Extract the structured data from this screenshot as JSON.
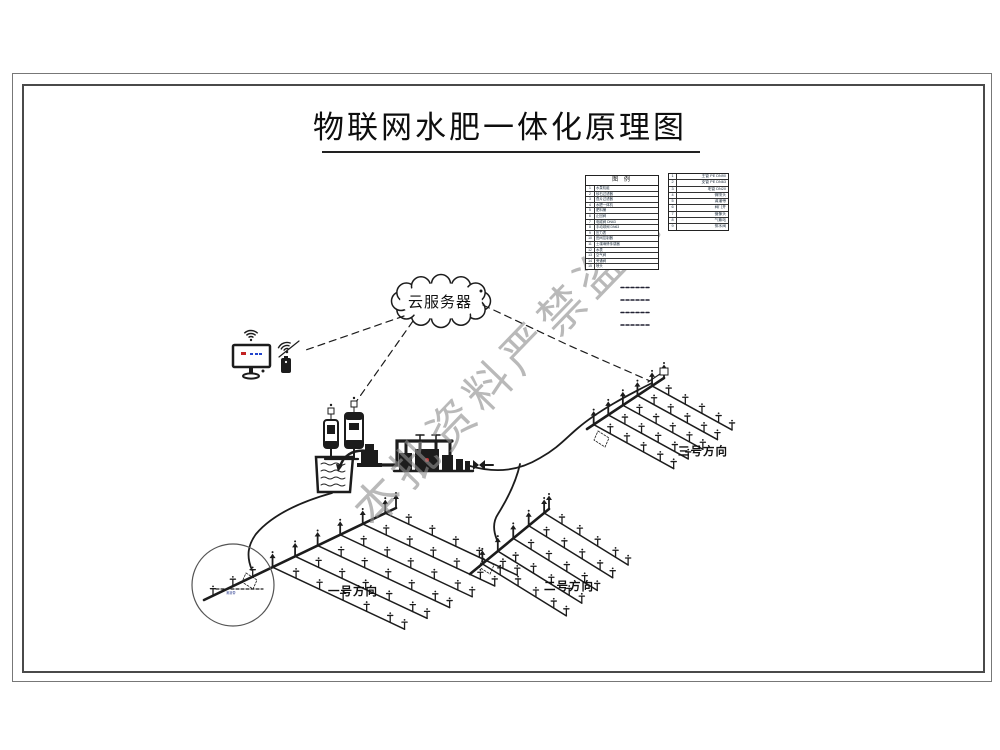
{
  "page": {
    "title": "物联网水肥一体化原理图",
    "watermark": "本批资料严禁盗用"
  },
  "cloud": {
    "label": "云服务器"
  },
  "legend": {
    "header": "图 例",
    "table1": [
      {
        "no": "1",
        "name": "水泵机组"
      },
      {
        "no": "2",
        "name": "砂石过滤器"
      },
      {
        "no": "3",
        "name": "叠片过滤器"
      },
      {
        "no": "4",
        "name": "水肥一体机"
      },
      {
        "no": "5",
        "name": "肥料桶"
      },
      {
        "no": "6",
        "name": "止回阀"
      },
      {
        "no": "7",
        "name": "电磁阀 DN63"
      },
      {
        "no": "8",
        "name": "手动球阀 DN63"
      },
      {
        "no": "9",
        "name": "压力表"
      },
      {
        "no": "10",
        "name": "田间控制器"
      },
      {
        "no": "11",
        "name": "土壤墒情传感器"
      },
      {
        "no": "12",
        "name": "水表"
      },
      {
        "no": "13",
        "name": "空气阀"
      },
      {
        "no": "14",
        "name": "旁通阀"
      },
      {
        "no": "15",
        "name": "喷头"
      }
    ],
    "table2": [
      {
        "no": "1",
        "name": "主管 PE DN90"
      },
      {
        "no": "2",
        "name": "支管 PE DN63"
      },
      {
        "no": "3",
        "name": "毛管 DN20"
      },
      {
        "no": "4",
        "name": "微喷头"
      },
      {
        "no": "5",
        "name": "滴灌带"
      },
      {
        "no": "6",
        "name": "阀门井"
      },
      {
        "no": "7",
        "name": "摄像头"
      },
      {
        "no": "8",
        "name": "气象站"
      },
      {
        "no": "9",
        "name": "排水阀"
      }
    ]
  },
  "fields": [
    {
      "label": "一号方向"
    },
    {
      "label": "二号方向"
    },
    {
      "label": "三号方向"
    }
  ],
  "detail": {
    "note": "滴灌带"
  }
}
